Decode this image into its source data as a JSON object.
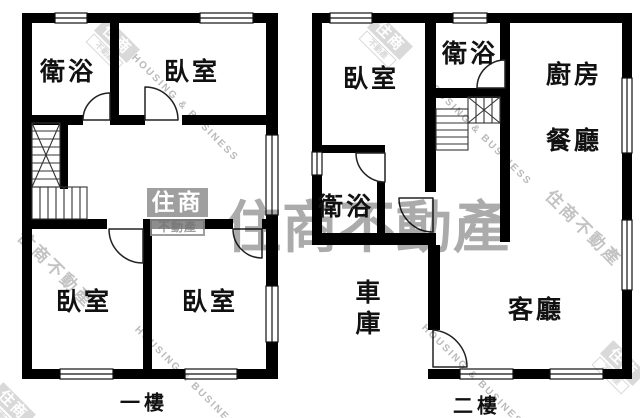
{
  "floors": [
    {
      "label": "一樓",
      "rooms": [
        {
          "name": "衛浴"
        },
        {
          "name": "臥室"
        },
        {
          "name": "臥室"
        },
        {
          "name": "臥室"
        }
      ]
    },
    {
      "label": "二樓",
      "rooms": [
        {
          "name": "臥室"
        },
        {
          "name": "衛浴"
        },
        {
          "name": "廚房"
        },
        {
          "name": "餐廳"
        },
        {
          "name": "衛浴"
        },
        {
          "name": "車庫"
        },
        {
          "name": "客廳"
        }
      ]
    }
  ],
  "watermark": {
    "brand_short": "住商",
    "brand_suffix": "不動產",
    "brand_full": "住商不動產",
    "brand_en": "HOUSING & BUSINESS"
  },
  "colors": {
    "wall": "#000000",
    "watermark_gray": "#8b8b8b",
    "background": "#ffffff"
  }
}
